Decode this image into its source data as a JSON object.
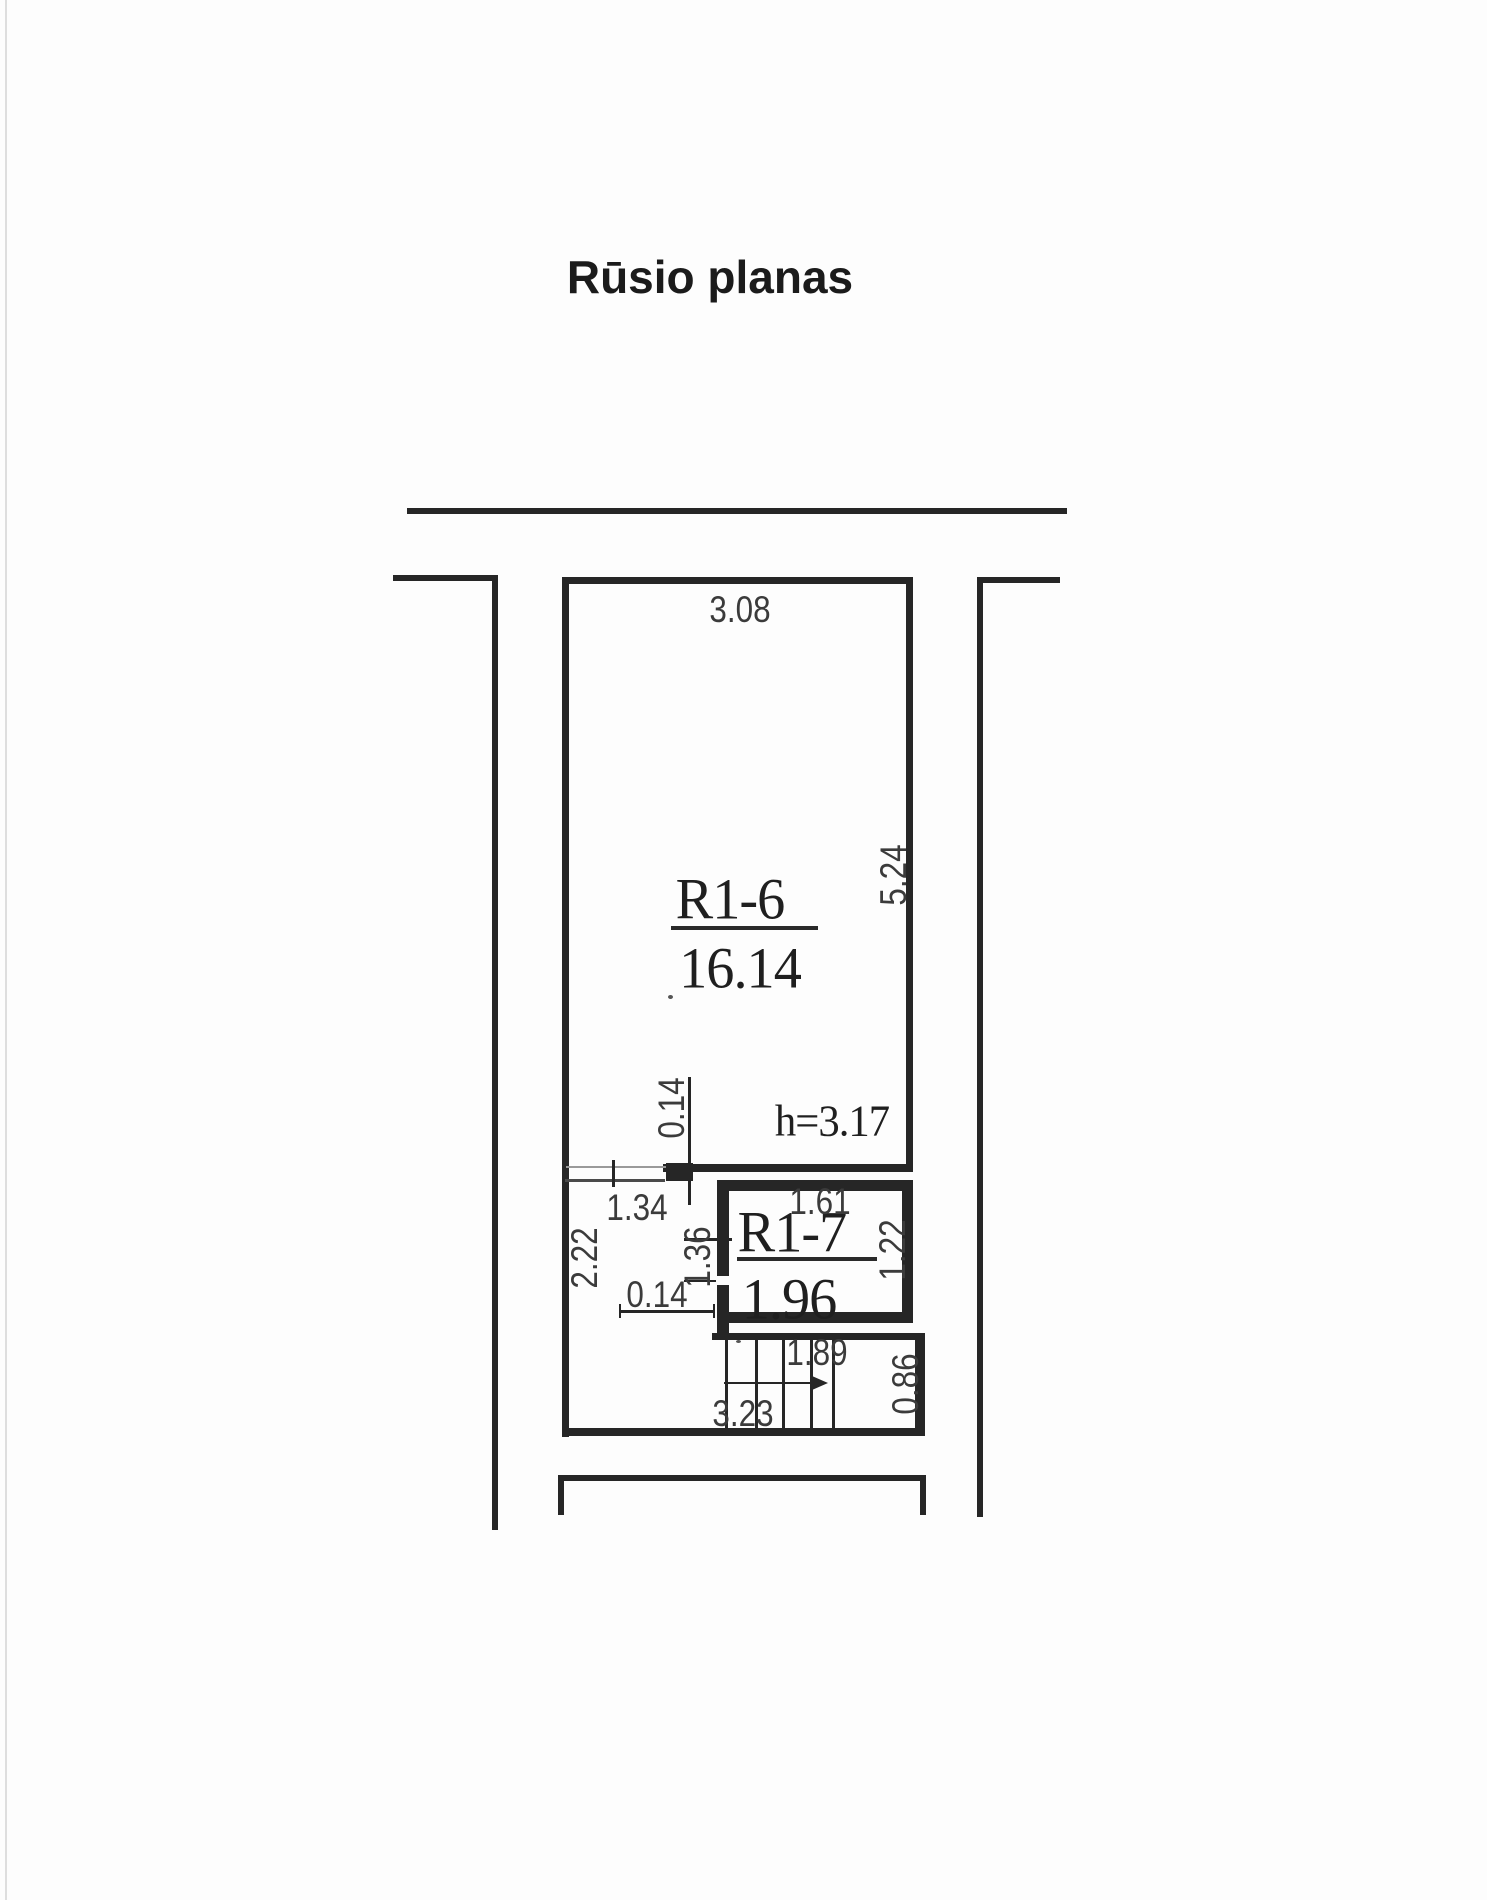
{
  "document": {
    "title": "Rūsio planas"
  },
  "rooms": {
    "r16": {
      "id": "R1-6",
      "area": "16.14",
      "height_note": "h=3.17"
    },
    "r17": {
      "id": "R1-7",
      "area": "1.96"
    }
  },
  "dimensions": {
    "r16_top_width": "3.08",
    "r16_right_height": "5.24",
    "wall_thickness_upper": "0.14",
    "opening_width": "1.34",
    "corridor_left_height": "2.22",
    "partition_height": "1.36",
    "wall_thickness_lower": "0.14",
    "r17_top_width": "1.61",
    "r17_right_height": "1.22",
    "stairs_run_width": "1.89",
    "stairs_total_width": "3.23",
    "stairs_depth": "0.86"
  }
}
